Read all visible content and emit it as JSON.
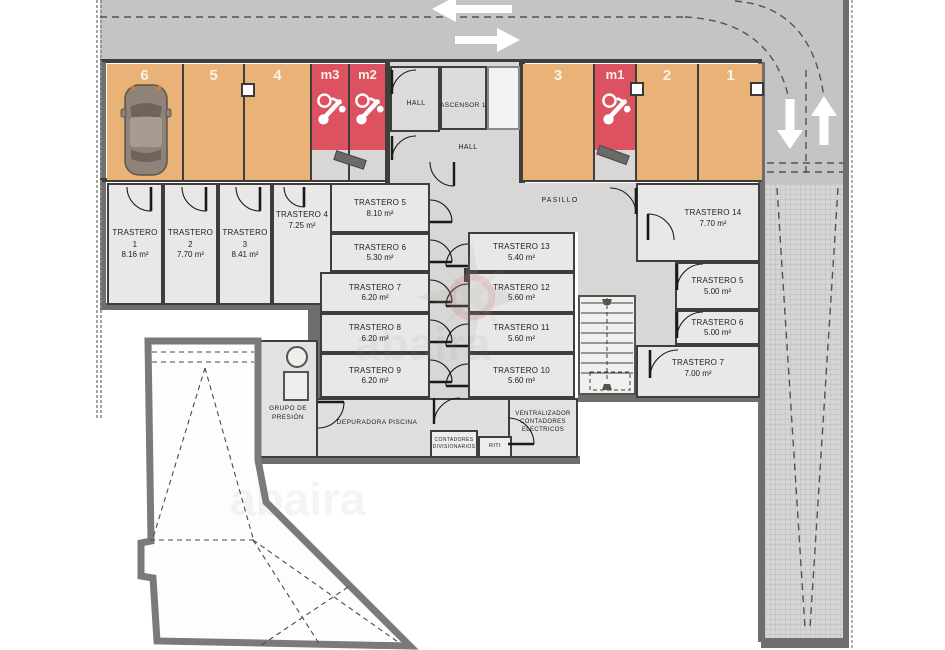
{
  "document": {
    "type": "basement floor plan - parking and storage"
  },
  "parking": {
    "spaces": [
      {
        "id": "6",
        "kind": "car",
        "occupied": "car"
      },
      {
        "id": "5",
        "kind": "car",
        "occupied": ""
      },
      {
        "id": "4",
        "kind": "car",
        "occupied": ""
      },
      {
        "id": "m3",
        "kind": "moto",
        "occupied": ""
      },
      {
        "id": "m2",
        "kind": "moto",
        "occupied": ""
      },
      {
        "id": "3",
        "kind": "car",
        "occupied": ""
      },
      {
        "id": "m1",
        "kind": "moto",
        "occupied": ""
      },
      {
        "id": "2",
        "kind": "car",
        "occupied": ""
      },
      {
        "id": "1",
        "kind": "car",
        "occupied": ""
      }
    ]
  },
  "halls": {
    "hall_top": "HALL",
    "elevator": "ASCENSOR 1",
    "hall_mid": "HALL",
    "corridor": "PASILLO"
  },
  "rooms": {
    "t1": {
      "name": "TRASTERO 1",
      "area": "8.16 m²"
    },
    "t2": {
      "name": "TRASTERO 2",
      "area": "7.70 m²"
    },
    "t3": {
      "name": "TRASTERO 3",
      "area": "8.41 m²"
    },
    "t4": {
      "name": "TRASTERO 4",
      "area": "7.25 m²"
    },
    "t5": {
      "name": "TRASTERO 5",
      "area": "8.10 m²"
    },
    "t6": {
      "name": "TRASTERO 6",
      "area": "5.30 m²"
    },
    "t7": {
      "name": "TRASTERO 7",
      "area": "6.20 m²"
    },
    "t8": {
      "name": "TRASTERO 8",
      "area": "6.20 m²"
    },
    "t9": {
      "name": "TRASTERO 9",
      "area": "6.20 m²"
    },
    "t10": {
      "name": "TRASTERO 10",
      "area": "5.60 m²"
    },
    "t11": {
      "name": "TRASTERO 11",
      "area": "5.60 m²"
    },
    "t12": {
      "name": "TRASTERO 12",
      "area": "5.60 m²"
    },
    "t13": {
      "name": "TRASTERO 13",
      "area": "5.40 m²"
    },
    "t14": {
      "name": "TRASTERO 14",
      "area": "7.70 m²"
    },
    "r5": {
      "name": "TRASTERO 5",
      "area": "5.00 m²"
    },
    "r6": {
      "name": "TRASTERO 6",
      "area": "5.00 m²"
    },
    "r7": {
      "name": "TRASTERO 7",
      "area": "7.00 m²"
    }
  },
  "utility": {
    "grupo": "GRUPO DE PRESIÓN",
    "depuradora": "DEPURADORA PISCINA",
    "contadores": "CONTADORES DIVISIONARIOS",
    "riti": "RITI",
    "ventralizador": "VENTRALIZADOR CONTADORES ELECTRICOS"
  },
  "watermark": {
    "text": "abaira"
  },
  "colors": {
    "car_space": "#e9b377",
    "moto_space": "#dc5260",
    "road": "#c5c4c3",
    "outer_wall": "#6f6e6c",
    "partition_wall": "#3f3e3c",
    "room_floor": "#e9e8e6",
    "corridor_floor": "#d8d7d5"
  }
}
